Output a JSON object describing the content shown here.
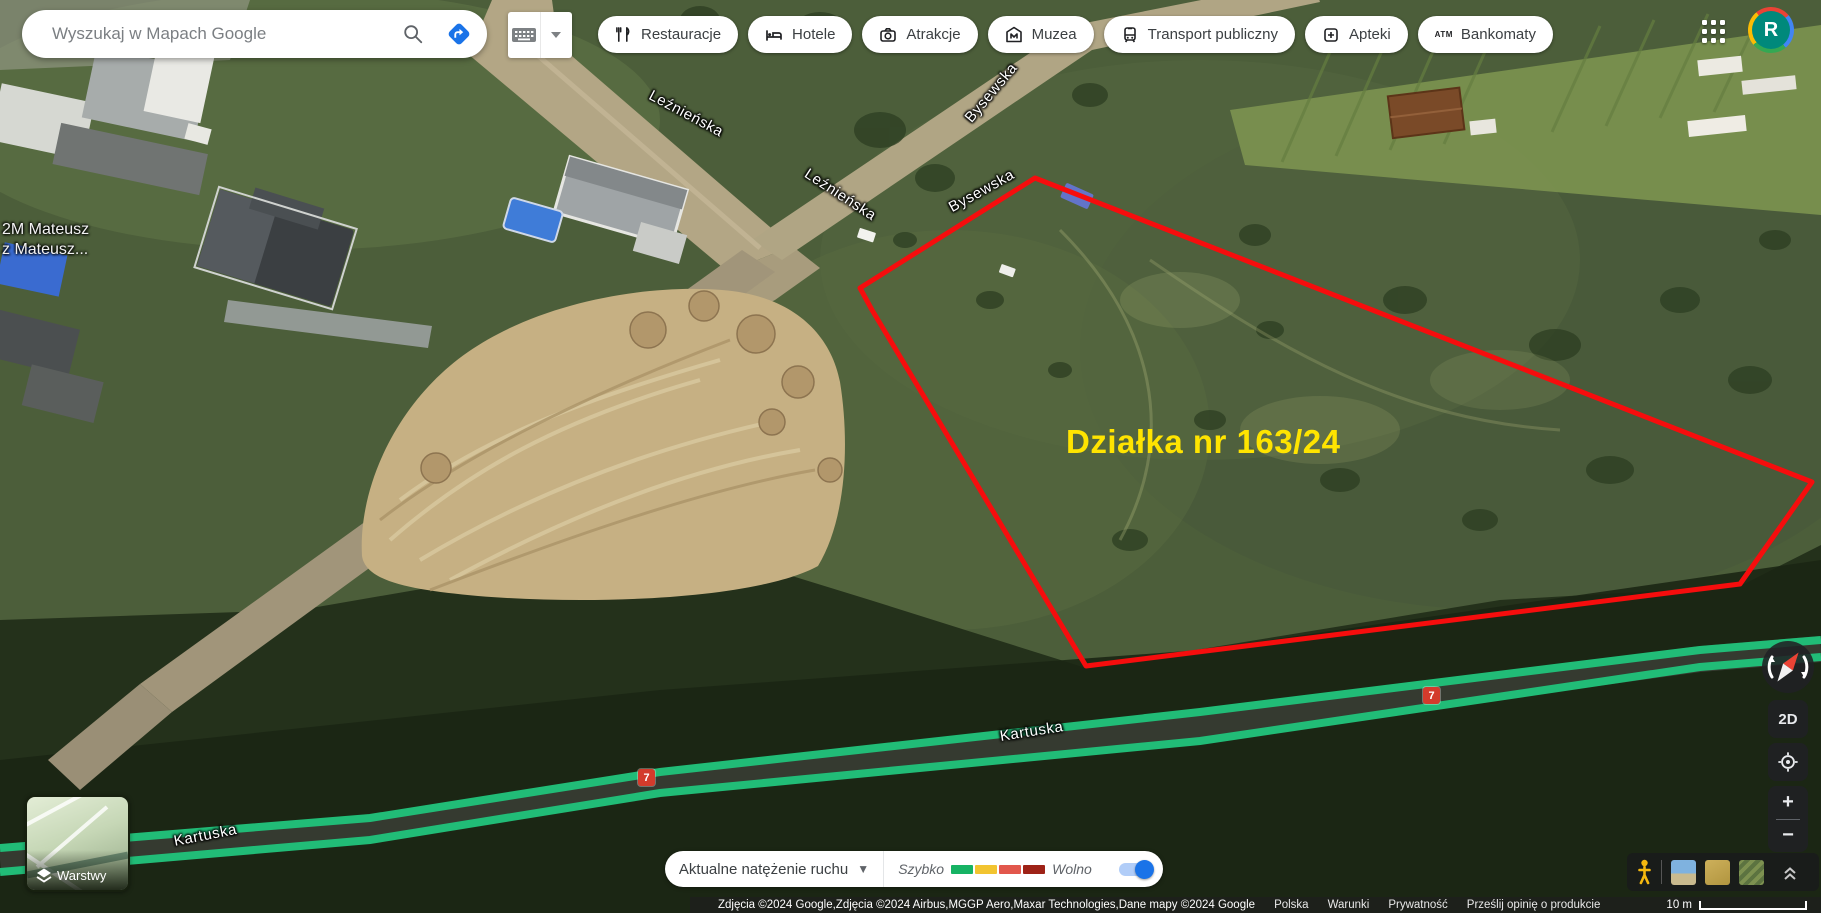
{
  "header": {
    "search": {
      "placeholder": "Wyszukaj w Mapach Google"
    },
    "chips": [
      {
        "label": "Restauracje",
        "icon": "restaurant-icon"
      },
      {
        "label": "Hotele",
        "icon": "hotel-icon"
      },
      {
        "label": "Atrakcje",
        "icon": "attractions-icon"
      },
      {
        "label": "Muzea",
        "icon": "museum-icon"
      },
      {
        "label": "Transport publiczny",
        "icon": "transit-icon"
      },
      {
        "label": "Apteki",
        "icon": "pharmacy-icon"
      },
      {
        "label": "Bankomaty",
        "icon": "atm-icon",
        "icon_text": "ATM"
      }
    ],
    "avatar_letter": "R"
  },
  "map": {
    "street_labels": [
      {
        "text": "Leźnieńska"
      },
      {
        "text": "Leźnieńska"
      },
      {
        "text": "Bysewska"
      },
      {
        "text": "Bysewska"
      },
      {
        "text": "Kartuska"
      },
      {
        "text": "Kartuska"
      }
    ],
    "route_shields": [
      {
        "text": "7"
      },
      {
        "text": "7"
      }
    ],
    "poi_label": {
      "line1": "2M Mateusz",
      "line2": "z Mateusz..."
    },
    "parcel_label": "Działka nr 163/24",
    "colors": {
      "parcel_outline": "#f60d0d",
      "parcel_label": "#ffe400",
      "traffic_fast_line": "#21bc77"
    }
  },
  "layers": {
    "label": "Warstwy"
  },
  "traffic_bar": {
    "dropdown_label": "Aktualne natężenie ruchu",
    "legend_fast": "Szybko",
    "legend_slow": "Wolno",
    "legend_colors": [
      "#16b364",
      "#f2c430",
      "#e2574c",
      "#9e2217"
    ],
    "toggle_on": true
  },
  "controls": {
    "map_mode": "2D",
    "zoom_in": "+",
    "zoom_out": "−"
  },
  "footer": {
    "attribution": "Zdjęcia ©2024 Google,Zdjęcia ©2024 Airbus,MGGP Aero,Maxar Technologies,Dane mapy ©2024 Google",
    "links": [
      "Polska",
      "Warunki",
      "Prywatność",
      "Prześlij opinię o produkcie"
    ],
    "scale_label": "10 m"
  }
}
